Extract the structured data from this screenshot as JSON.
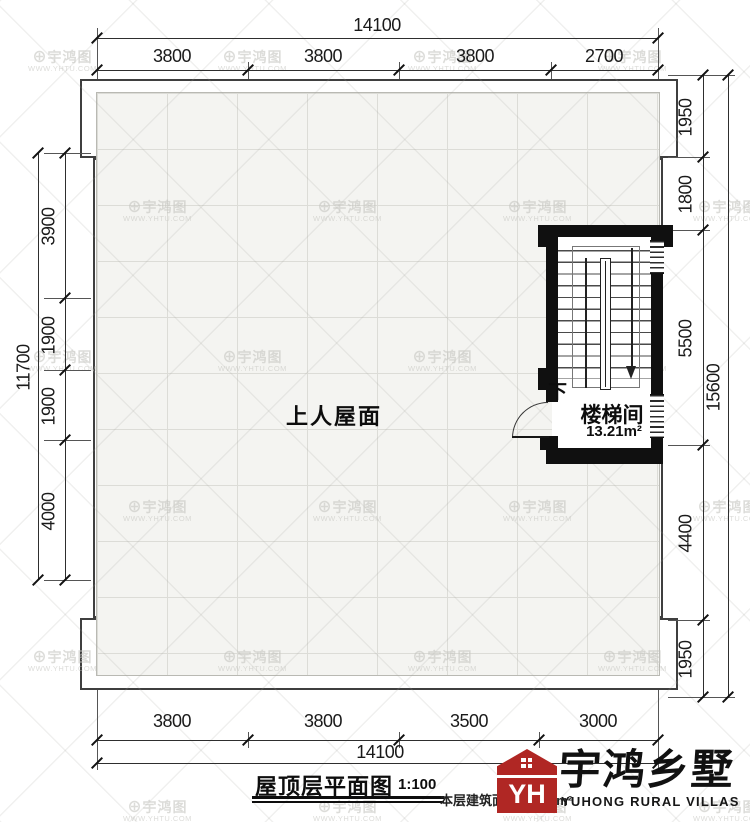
{
  "plan": {
    "roof_label": "上人屋面",
    "stair_room_label": "楼梯间",
    "stair_room_area": "13.21m²",
    "down_label": "下"
  },
  "dims": {
    "top": {
      "total": "14100",
      "segments": [
        "3800",
        "3800",
        "3800",
        "2700"
      ]
    },
    "bottom": {
      "total": "14100",
      "segments": [
        "3800",
        "3800",
        "3500",
        "3000"
      ]
    },
    "left": {
      "total": "11700",
      "segments": [
        "3900",
        "1900",
        "1900",
        "4000"
      ]
    },
    "right": {
      "total": "15600",
      "segments": [
        "1950",
        "1800",
        "5500",
        "4400",
        "1950"
      ]
    }
  },
  "titleblock": {
    "title": "屋顶层平面图",
    "scale": "1:100",
    "area_note": "本层建筑面积：9.52m²"
  },
  "logo": {
    "name_cn": "宇鸿乡墅",
    "name_en": "YUHONG RURAL VILLAS",
    "monogram": "YH",
    "icon_color": "#b02724"
  },
  "watermark": {
    "icon": "⊕",
    "text_cn": "宇鸿图",
    "text_url": "WWW.YHTU.COM"
  },
  "colors": {
    "line": "#2e2e2e",
    "wall": "#101010",
    "roof_fill": "#f4f4f1",
    "grid": "#dcdcd7",
    "accent_red": "#b02724",
    "watermark": "#c9c9c4"
  }
}
